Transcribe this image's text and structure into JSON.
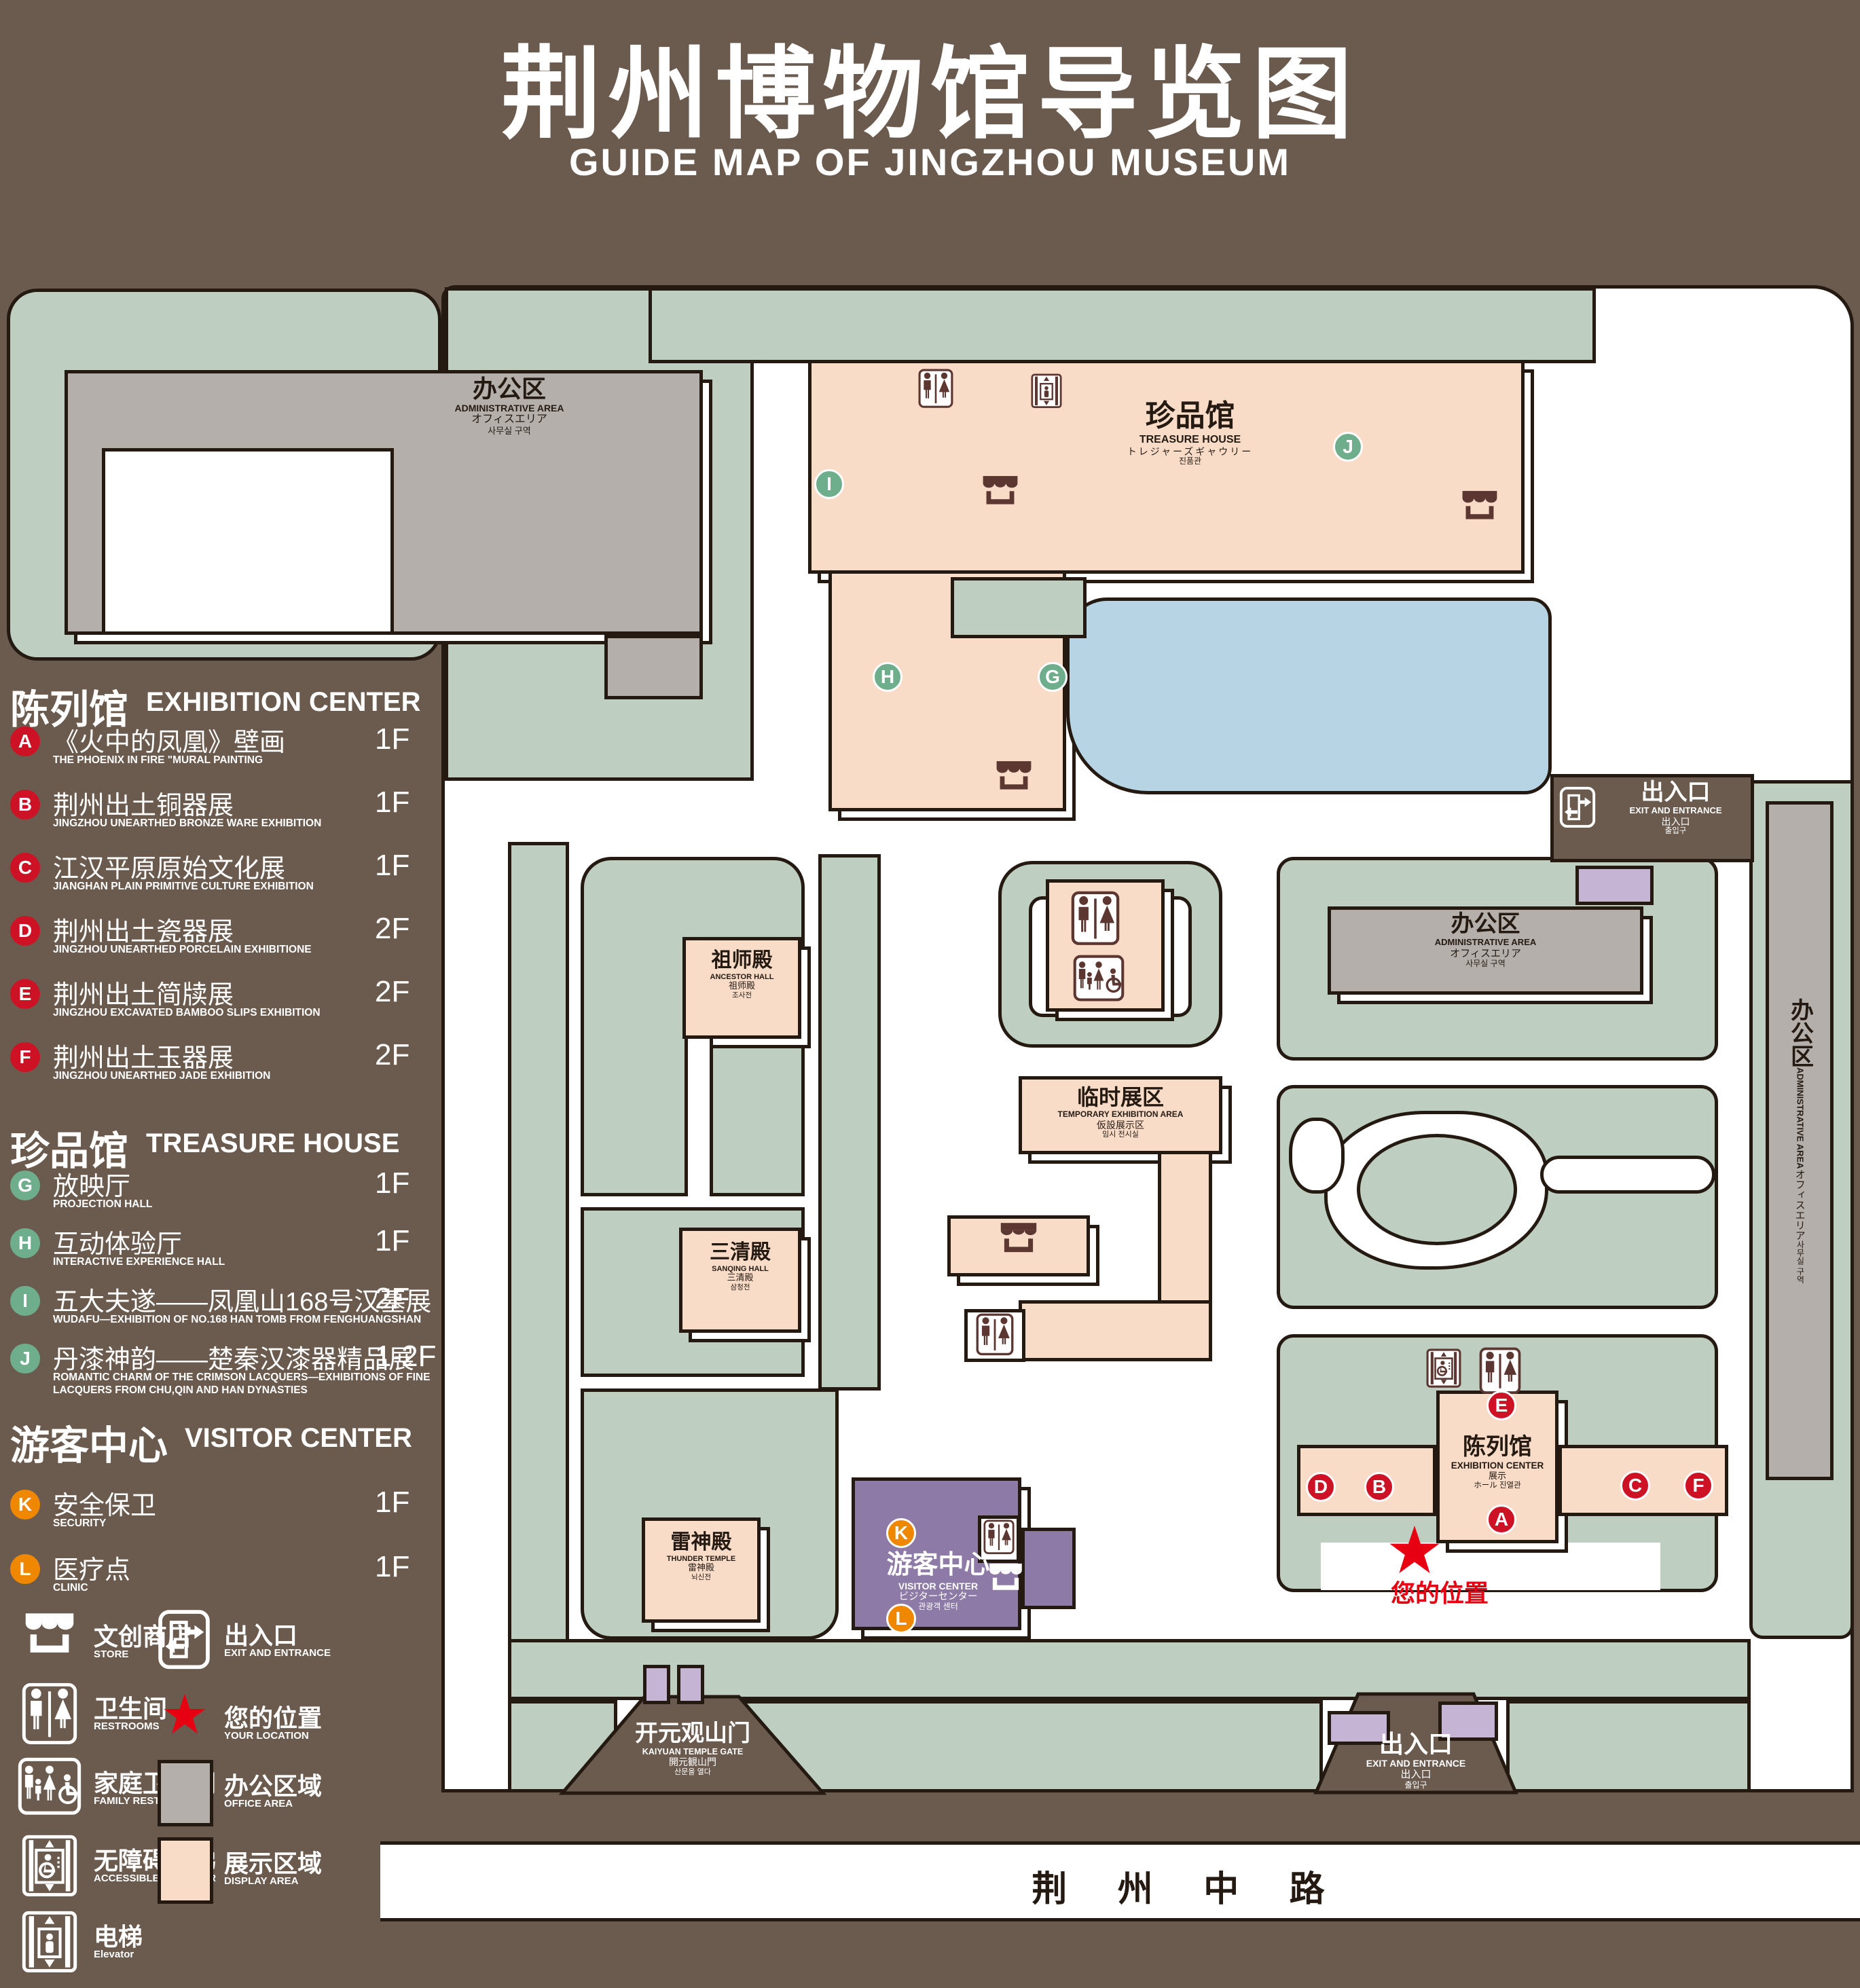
{
  "title": {
    "zh": "荆州博物馆导览图",
    "en": "GUIDE MAP OF JINGZHOU MUSEUM"
  },
  "colors": {
    "background": "#6B5B4E",
    "lawn_green": "#BECFC1",
    "display_area_peach": "#F9DCC8",
    "office_gray": "#B5AFAB",
    "pond_blue": "#B6D4E3",
    "visitor_center_purple": "#8E7AA6",
    "small_building_lavender": "#C6B4D4",
    "outline": "#241A12",
    "icon_brown": "#5C3630",
    "badge_red": "#CE1225",
    "badge_green": "#6FAE8D",
    "badge_orange": "#F08700",
    "location_red": "#E60012",
    "white": "#FFFFFF"
  },
  "legend": {
    "sections": [
      {
        "id": "exhibition-center",
        "zh": "陈列馆",
        "en": "EXHIBITION CENTER",
        "badge": "red",
        "items": [
          {
            "letter": "A",
            "zh": "《火中的凤凰》壁画",
            "en": "THE PHOENIX IN FIRE \"MURAL PAINTING",
            "floor": "1F"
          },
          {
            "letter": "B",
            "zh": "荆州出土铜器展",
            "en": "JINGZHOU UNEARTHED BRONZE WARE EXHIBITION",
            "floor": "1F"
          },
          {
            "letter": "C",
            "zh": "江汉平原原始文化展",
            "en": "JIANGHAN PLAIN PRIMITIVE CULTURE EXHIBITION",
            "floor": "1F"
          },
          {
            "letter": "D",
            "zh": "荆州出土瓷器展",
            "en": "JINGZHOU UNEARTHED PORCELAIN EXHIBITIONE",
            "floor": "2F"
          },
          {
            "letter": "E",
            "zh": "荆州出土简牍展",
            "en": "JINGZHOU EXCAVATED BAMBOO SLIPS EXHIBITION",
            "floor": "2F"
          },
          {
            "letter": "F",
            "zh": "荆州出土玉器展",
            "en": "JINGZHOU UNEARTHED JADE EXHIBITION",
            "floor": "2F"
          }
        ]
      },
      {
        "id": "treasure-house",
        "zh": "珍品馆",
        "en": "TREASURE HOUSE",
        "badge": "green",
        "items": [
          {
            "letter": "G",
            "zh": "放映厅",
            "en": "PROJECTION HALL",
            "floor": "1F"
          },
          {
            "letter": "H",
            "zh": "互动体验厅",
            "en": "INTERACTIVE EXPERIENCE HALL",
            "floor": "1F"
          },
          {
            "letter": "I",
            "zh": "五大夫遂——凤凰山168号汉墓展",
            "en": "WUDAFU—EXHIBITION OF NO.168 HAN TOMB FROM FENGHUANGSHAN",
            "floor": "2F"
          },
          {
            "letter": "J",
            "zh": "丹漆神韵——楚秦汉漆器精品展",
            "en": "ROMANTIC CHARM OF THE CRIMSON LACQUERS—EXHIBITIONS OF FINE LACQUERS FROM CHU,QIN AND HAN DYNASTIES",
            "floor": "1-2F"
          }
        ]
      },
      {
        "id": "visitor-center",
        "zh": "游客中心",
        "en": "VISITOR CENTER",
        "badge": "orange",
        "items": [
          {
            "letter": "K",
            "zh": "安全保卫",
            "en": "SECURITY",
            "floor": "1F"
          },
          {
            "letter": "L",
            "zh": "医疗点",
            "en": "CLINIC",
            "floor": "1F"
          }
        ]
      }
    ],
    "symbols": [
      {
        "icon": "store",
        "zh": "文创商店",
        "en": "STORE"
      },
      {
        "icon": "exit",
        "zh": "出入口",
        "en": "EXIT AND ENTRANCE"
      },
      {
        "icon": "restrooms",
        "zh": "卫生间",
        "en": "RESTROOMS"
      },
      {
        "icon": "location",
        "zh": "您的位置",
        "en": "YOUR LOCATION"
      },
      {
        "icon": "family-restrooms",
        "zh": "家庭卫生间",
        "en": "FAMILY RESTROOMS"
      },
      {
        "icon": "office-swatch",
        "zh": "办公区域",
        "en": "OFFICE AREA"
      },
      {
        "icon": "accessible-elevator",
        "zh": "无障碍电梯",
        "en": "ACCESSIBLE ELEVATOR"
      },
      {
        "icon": "display-swatch",
        "zh": "展示区域",
        "en": "DISPLAY AREA"
      },
      {
        "icon": "elevator",
        "zh": "电梯",
        "en": "Elevator"
      }
    ]
  },
  "map": {
    "labels": {
      "administrative_area": {
        "zh": "办公区",
        "en": "ADMINISTRATIVE AREA",
        "ja": "オフィスエリア",
        "ko": "사무실 구역"
      },
      "treasure_house": {
        "zh": "珍品馆",
        "en": "TREASURE HOUSE",
        "ja": "トレジャーズギャウリー",
        "ko": "진품관"
      },
      "ancestor_hall": {
        "zh": "祖师殿",
        "en": "ANCESTOR HALL",
        "ja": "祖师殿",
        "ko": "조사전"
      },
      "sanqing_hall": {
        "zh": "三清殿",
        "en": "SANQING HALL",
        "ja": "三清殿",
        "ko": "삼청전"
      },
      "thunder_temple": {
        "zh": "雷神殿",
        "en": "THUNDER TEMPLE",
        "ja": "雷神殿",
        "ko": "뇌신전"
      },
      "temporary_exhibition": {
        "zh": "临时展区",
        "en": "TEMPORARY EXHIBITION AREA",
        "ja": "仮設展示区",
        "ko": "임시 전시실"
      },
      "exhibition_center": {
        "zh": "陈列馆",
        "en": "EXHIBITION CENTER",
        "ja": "展示",
        "ko": "ホール 진열관"
      },
      "visitor_center": {
        "zh": "游客中心",
        "en": "VISITOR CENTER",
        "ja": "ビジターセンター",
        "ko": "관광객 센터"
      },
      "gate": {
        "zh": "开元观山门",
        "en": "KAIYUAN TEMPLE GATE",
        "ja": "開元観山門",
        "ko": "산문을 열다"
      },
      "exit": {
        "zh": "出入口",
        "en": "EXIT AND ENTRANCE",
        "ja": "出入口",
        "ko": "출입구"
      }
    },
    "badges": [
      "A",
      "B",
      "C",
      "D",
      "E",
      "F",
      "G",
      "H",
      "I",
      "J",
      "K",
      "L"
    ],
    "road": {
      "zh": "荆 州 中 路"
    },
    "your_location": {
      "zh": "您的位置"
    }
  }
}
